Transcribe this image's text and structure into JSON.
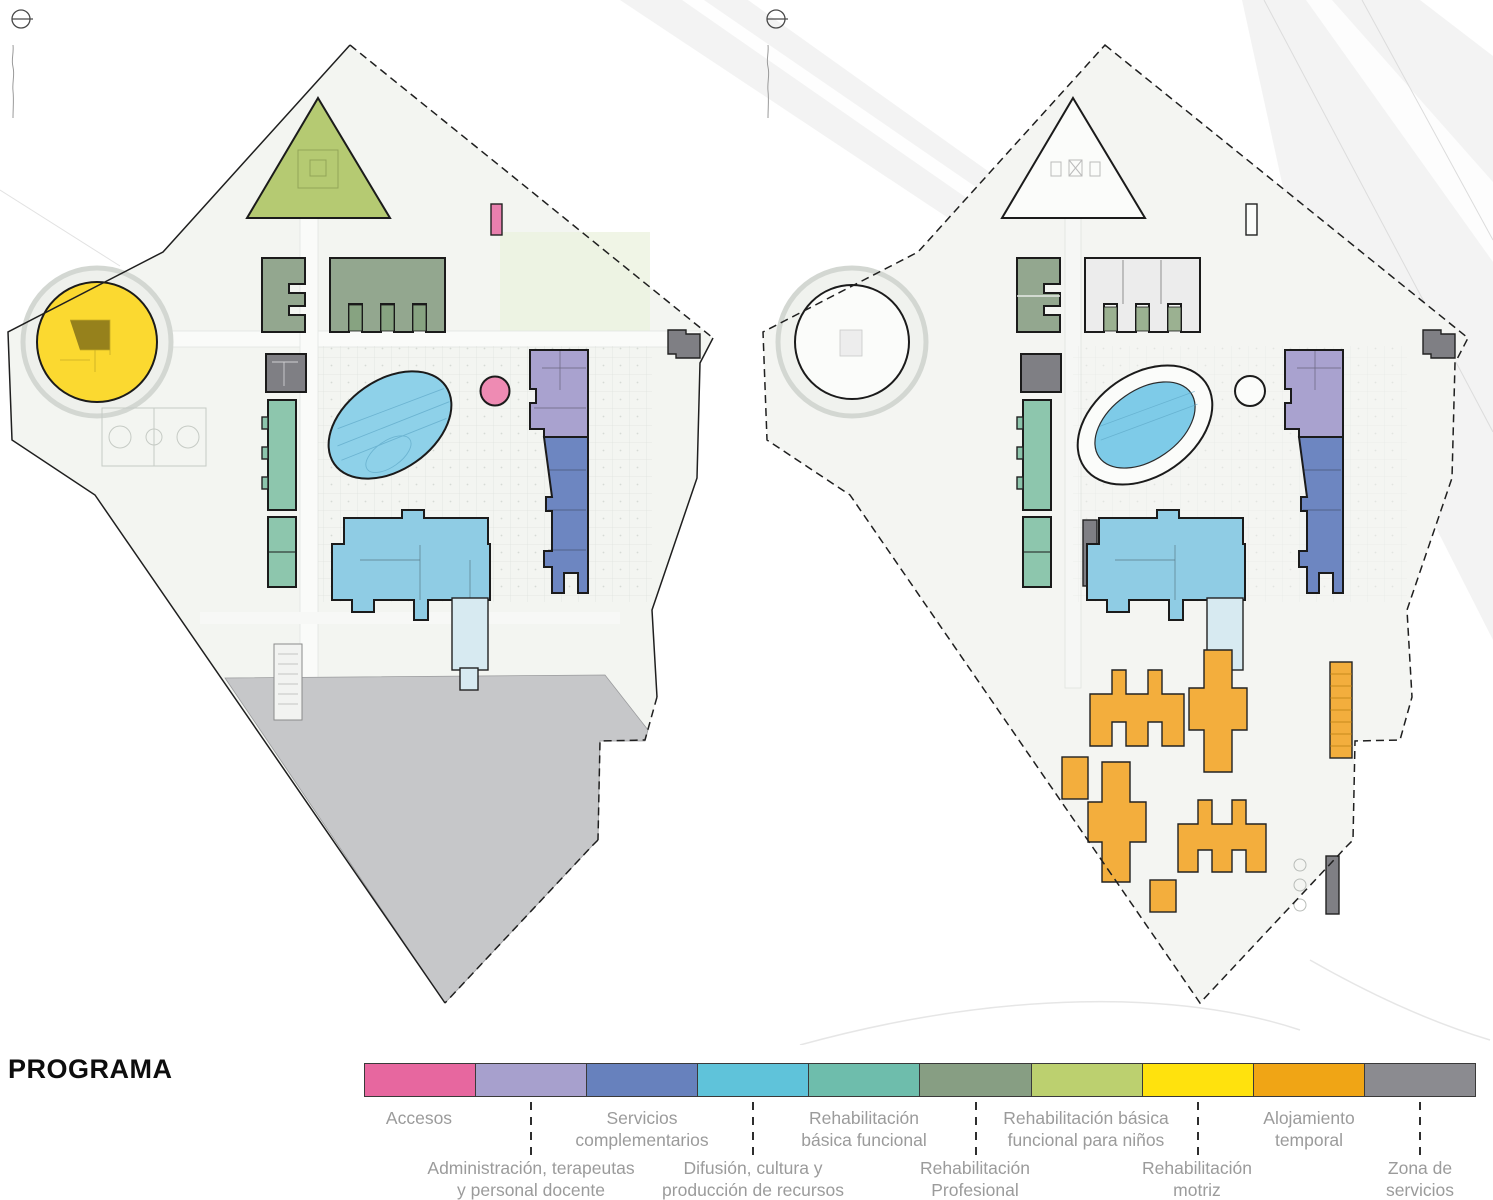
{
  "title": "PROGRAMA",
  "legend": {
    "items": [
      {
        "id": "accesos",
        "label": "Accesos",
        "color": "#e7679f",
        "label_row": "top"
      },
      {
        "id": "administracion-terapeutas",
        "label": "Administración, terapeutas\ny personal docente",
        "color": "#a7a0cd",
        "label_row": "bottom"
      },
      {
        "id": "servicios-complementarios",
        "label": "Servicios\ncomplementarios",
        "color": "#6781bd",
        "label_row": "top"
      },
      {
        "id": "difusion-cultura",
        "label": "Difusión, cultura y\nproducción de recursos",
        "color": "#5fc3da",
        "label_row": "bottom"
      },
      {
        "id": "rehabilitacion-basica-funcional",
        "label": "Rehabilitación\nbásica funcional",
        "color": "#6ebdac",
        "label_row": "top"
      },
      {
        "id": "rehabilitacion-profesional",
        "label": "Rehabilitación\nProfesional",
        "color": "#879e83",
        "label_row": "bottom"
      },
      {
        "id": "rehabilitacion-basica-ninos",
        "label": "Rehabilitación básica\nfuncional para niños",
        "color": "#bcd06f",
        "label_row": "top"
      },
      {
        "id": "rehabilitacion-motriz",
        "label": "Rehabilitación\nmotriz",
        "color": "#ffe20d",
        "label_row": "bottom"
      },
      {
        "id": "alojamiento-temporal",
        "label": "Alojamiento\ntemporal",
        "color": "#f0a515",
        "label_row": "top"
      },
      {
        "id": "zona-servicios",
        "label": "Zona de\nservicios",
        "color": "#8b8b90",
        "label_row": "bottom"
      }
    ]
  },
  "palette": {
    "pool_left": "#8ed1e9",
    "pool_inner_right": "#7ecbe8",
    "service_area_grey": "#c6c7c9",
    "site_ground": "#f3f5f1",
    "triangle_fill": "#b5ca72",
    "circle_building_fill": "#fbd930",
    "building_outline": "#1b1b1b"
  }
}
